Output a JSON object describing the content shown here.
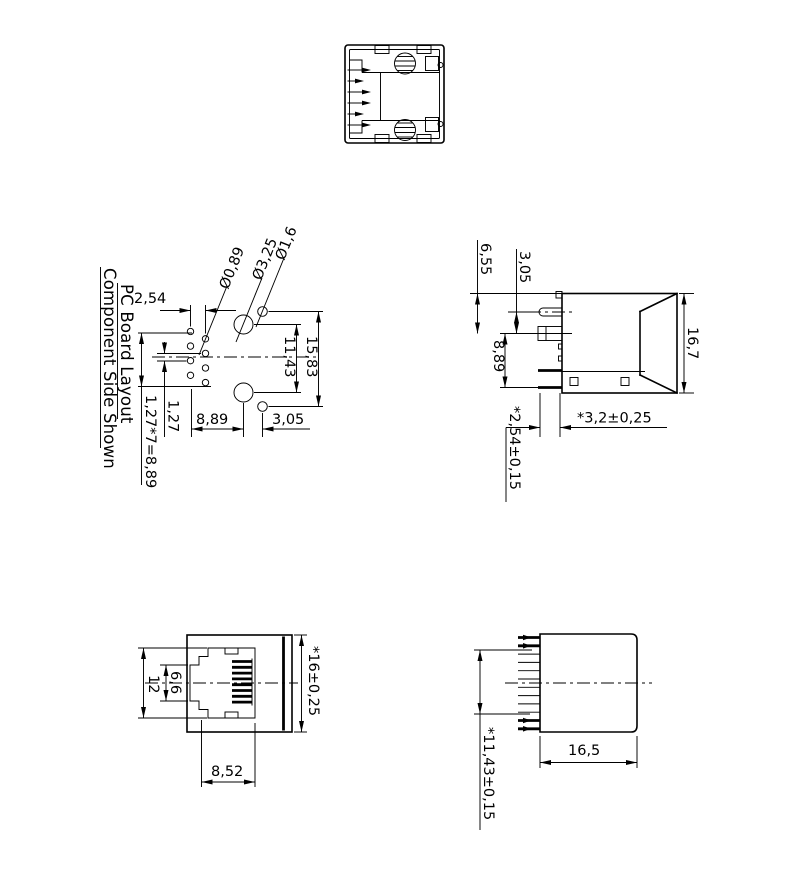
{
  "drawing": {
    "pcb": {
      "title1": "PC Board Layout",
      "title2": "Component Side Shown",
      "col_pitch": "2,54",
      "dia_small": "Ø0,89",
      "dia_large": "Ø3,25",
      "dia_mid": "Ø1,6",
      "span_large_holes": "11,43",
      "span_mid_holes": "15,83",
      "row_pitch": "1,27",
      "row_total": "1,27*7=8,89",
      "row_to_hole": "8,89",
      "hole_to_hole": "3,05"
    },
    "side": {
      "top_to_center": "6,55",
      "tab_to_center": "3,05",
      "height": "16,7",
      "center_to_leg": "8,89",
      "leg_length": "*3,2±0,25",
      "leg_pitch": "*2,54±0,15"
    },
    "front": {
      "opening_width": "12",
      "latch_width": "6,6",
      "body_width": "*16±0,25",
      "opening_depth": "8,52"
    },
    "rear": {
      "contact_span": "*11,43±0,15",
      "body_depth": "16,5"
    },
    "colors": {
      "line": "#000000",
      "background": "#ffffff"
    }
  }
}
